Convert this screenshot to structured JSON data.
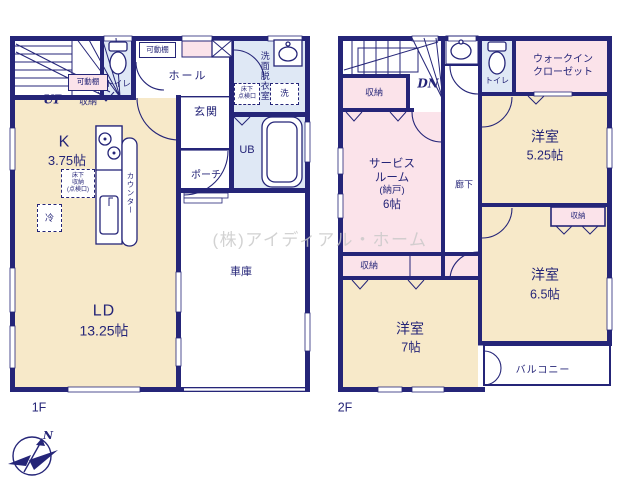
{
  "watermark": "(株)アイディアル・ホーム",
  "compass": {
    "north": "N"
  },
  "colors": {
    "wall": "#252578",
    "cream": "#f7e9c9",
    "pink": "#fbe3ea",
    "blue": "#dfe8f5",
    "watermark": "#c8c8c8"
  },
  "floor1": {
    "label": "1F",
    "stairs_up": "UP",
    "movable_shelf_stairs": "可動棚",
    "movable_shelf_hall": "可動棚",
    "storage": "収納",
    "toilet": "トイレ",
    "hall": "ホール",
    "entrance": "玄関",
    "porch": "ポーチ",
    "washroom_vertical": "洗面脱衣室",
    "underfloor_hatch_lines": [
      "床下",
      "点検口"
    ],
    "washer": "洗",
    "unit_bath": "UB",
    "kitchen": "K",
    "kitchen_size": "3.75帖",
    "underfloor_storage_lines": [
      "床下",
      "収納",
      "(点検口)"
    ],
    "fridge": "冷",
    "counter_vertical": "カウンター",
    "living_dining": "LD",
    "living_dining_size": "13.25帖",
    "garage": "車庫"
  },
  "floor2": {
    "label": "2F",
    "stairs_down": "DN",
    "storage_top": "収納",
    "toilet": "トイレ",
    "wic_lines": [
      "ウォークイン",
      "クローゼット"
    ],
    "service_room_lines": [
      "サービス",
      "ルーム",
      "(納戸)",
      "6帖"
    ],
    "corridor": "廊下",
    "room_a": "洋室",
    "room_a_size": "5.25帖",
    "storage_mid": "収納",
    "room_b": "洋室",
    "room_b_size": "6.5帖",
    "storage_strip": "収納",
    "room_c": "洋室",
    "room_c_size": "7帖",
    "balcony": "バルコニー"
  }
}
